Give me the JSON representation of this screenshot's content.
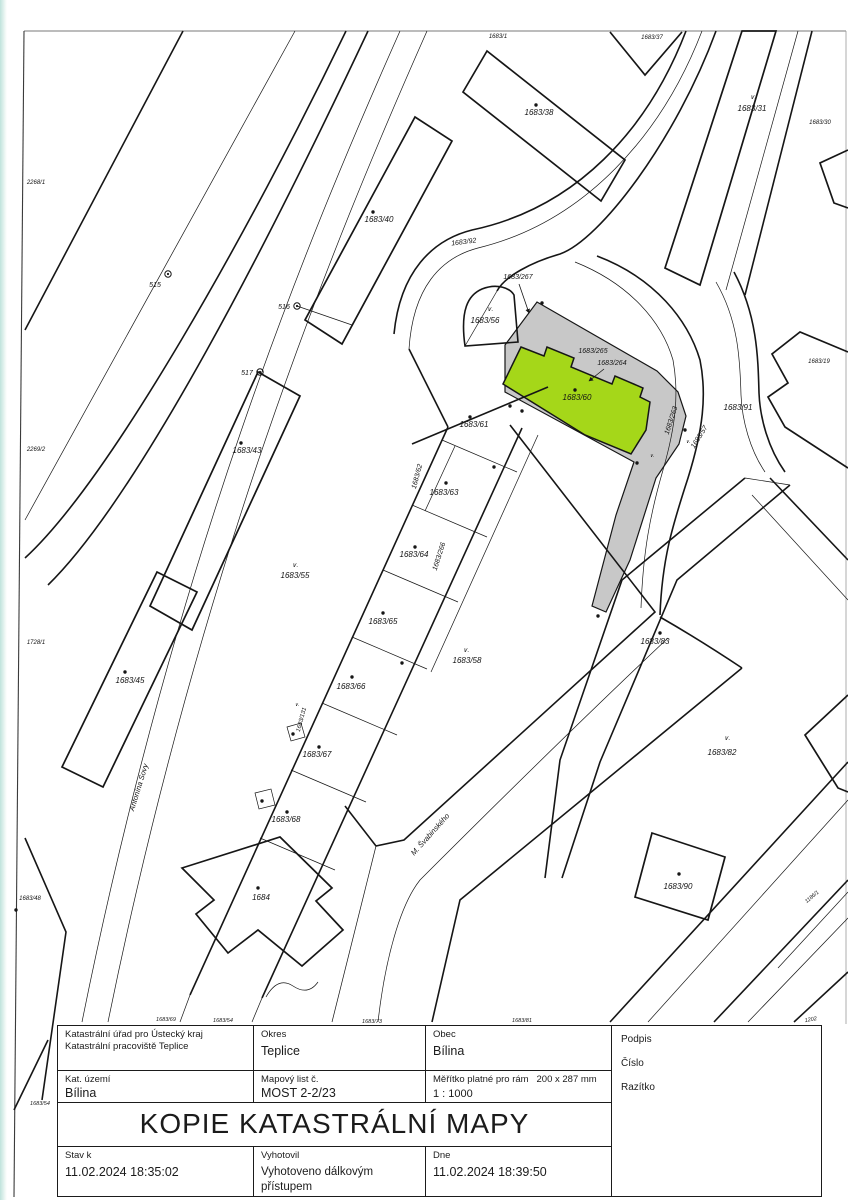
{
  "document": {
    "title": "KOPIE KATASTRÁLNÍ MAPY",
    "table": {
      "office_line1": "Katastrální úřad pro Ústecký kraj",
      "office_line2": "Katastrální pracoviště Teplice",
      "okres_label": "Okres",
      "okres_value": "Teplice",
      "obec_label": "Obec",
      "obec_value": "Bílina",
      "kat_uzemi_label": "Kat. území",
      "kat_uzemi_value": "Bílina",
      "mapovy_list_label": "Mapový list č.",
      "mapovy_list_value": "MOST 2-2/23",
      "meritko_label": "Měřítko platné pro rám",
      "meritko_frame": "200 x 287 mm",
      "meritko_value": "1 : 1000",
      "podpis_label": "Podpis",
      "cislo_label": "Číslo",
      "razitko_label": "Razítko",
      "stav_label": "Stav k",
      "stav_value": "11.02.2024 18:35:02",
      "vyhotovil_label": "Vyhotovil",
      "vyhotovil_value": "Vyhotoveno dálkovým přístupem",
      "dne_label": "Dne",
      "dne_value": "11.02.2024 18:39:50"
    }
  },
  "map": {
    "highlighted_parcel": "1683/60",
    "colors": {
      "highlight_green": "#a5d719",
      "area_gray": "#c8c8c8",
      "line": "#161616"
    },
    "labels": [
      {
        "t": "2268/1",
        "x": 36,
        "y": 184,
        "s": 6
      },
      {
        "t": "2269/2",
        "x": 36,
        "y": 451,
        "s": 6
      },
      {
        "t": "1728/1",
        "x": 36,
        "y": 644,
        "s": 6
      },
      {
        "t": "1683/48",
        "x": 30,
        "y": 900,
        "s": 6
      },
      {
        "t": "1683/54",
        "x": 40,
        "y": 1105,
        "s": 5.5
      },
      {
        "t": "515",
        "x": 155,
        "y": 287,
        "s": 7
      },
      {
        "t": "516",
        "x": 284,
        "y": 309,
        "s": 7
      },
      {
        "t": "517",
        "x": 247,
        "y": 375,
        "s": 7
      },
      {
        "t": "1683/43",
        "x": 247,
        "y": 453,
        "s": 8
      },
      {
        "t": "1683/45",
        "x": 130,
        "y": 683,
        "s": 8
      },
      {
        "t": "Antonína Sovy",
        "x": 141,
        "y": 788,
        "r": -73,
        "s": 7.5
      },
      {
        "t": "1683/40",
        "x": 379,
        "y": 222,
        "s": 8
      },
      {
        "t": "1683/38",
        "x": 539,
        "y": 115,
        "s": 8
      },
      {
        "t": "1683/1",
        "x": 498,
        "y": 38,
        "s": 6
      },
      {
        "t": "1683/37",
        "x": 652,
        "y": 39,
        "s": 6
      },
      {
        "t": "1683/31",
        "x": 752,
        "y": 111,
        "s": 8
      },
      {
        "t": "1683/30",
        "x": 820,
        "y": 124,
        "s": 6
      },
      {
        "t": "1683/92",
        "x": 464,
        "y": 244,
        "r": -7,
        "s": 7
      },
      {
        "t": "1683/267",
        "x": 518,
        "y": 279,
        "s": 7
      },
      {
        "t": "1683/56",
        "x": 485,
        "y": 323,
        "s": 8
      },
      {
        "t": "1683/265",
        "x": 593,
        "y": 353,
        "s": 7
      },
      {
        "t": "1683/264",
        "x": 612,
        "y": 365,
        "s": 7
      },
      {
        "t": "1683/60",
        "x": 577,
        "y": 400,
        "s": 8
      },
      {
        "t": "1683/61",
        "x": 474,
        "y": 427,
        "s": 8
      },
      {
        "t": "1683/62",
        "x": 419,
        "y": 477,
        "r": -75,
        "s": 7
      },
      {
        "t": "1683/63",
        "x": 444,
        "y": 495,
        "s": 8
      },
      {
        "t": "1683/266",
        "x": 441,
        "y": 557,
        "r": -72,
        "s": 7
      },
      {
        "t": "1683/64",
        "x": 414,
        "y": 557,
        "s": 8
      },
      {
        "t": "1683/65",
        "x": 383,
        "y": 624,
        "s": 8
      },
      {
        "t": "1683/55",
        "x": 295,
        "y": 578,
        "s": 8
      },
      {
        "t": "1683/58",
        "x": 467,
        "y": 663,
        "s": 8
      },
      {
        "t": "1683/66",
        "x": 351,
        "y": 689,
        "s": 8
      },
      {
        "t": "1683/131",
        "x": 303,
        "y": 720,
        "r": -75,
        "s": 6
      },
      {
        "t": "1683/67",
        "x": 317,
        "y": 757,
        "s": 8
      },
      {
        "t": "1683/68",
        "x": 286,
        "y": 822,
        "s": 8
      },
      {
        "t": "1684",
        "x": 261,
        "y": 900,
        "s": 8
      },
      {
        "t": "M. Švabinského",
        "x": 432,
        "y": 836,
        "r": -48,
        "s": 7.5
      },
      {
        "t": "1683/263",
        "x": 673,
        "y": 421,
        "r": -72,
        "s": 7
      },
      {
        "t": "1683/57",
        "x": 701,
        "y": 438,
        "r": -58,
        "s": 7
      },
      {
        "t": "1683/91",
        "x": 738,
        "y": 410,
        "s": 8
      },
      {
        "t": "1683/19",
        "x": 819,
        "y": 363,
        "s": 6
      },
      {
        "t": "1683/83",
        "x": 655,
        "y": 644,
        "s": 8
      },
      {
        "t": "1683/82",
        "x": 722,
        "y": 755,
        "s": 8
      },
      {
        "t": "1683/90",
        "x": 678,
        "y": 889,
        "s": 8
      },
      {
        "t": "1186/1",
        "x": 813,
        "y": 898,
        "r": -40,
        "s": 5.5
      },
      {
        "t": "1202",
        "x": 811,
        "y": 1021,
        "r": -10,
        "s": 5.5
      },
      {
        "t": "1683/69",
        "x": 166,
        "y": 1021,
        "s": 5.5
      },
      {
        "t": "1683/54",
        "x": 223,
        "y": 1022,
        "s": 5.5
      },
      {
        "t": "1683/73",
        "x": 372,
        "y": 1023,
        "s": 5.5
      },
      {
        "t": "1683/81",
        "x": 522,
        "y": 1022,
        "s": 5.5
      }
    ],
    "dots": [
      [
        536,
        105
      ],
      [
        373,
        212
      ],
      [
        241,
        443
      ],
      [
        125,
        672
      ],
      [
        575,
        390
      ],
      [
        470,
        417
      ],
      [
        446,
        483
      ],
      [
        415,
        547
      ],
      [
        383,
        613
      ],
      [
        352,
        677
      ],
      [
        319,
        747
      ],
      [
        287,
        812
      ],
      [
        258,
        888
      ],
      [
        660,
        633
      ],
      [
        679,
        874
      ],
      [
        542,
        303
      ],
      [
        510,
        406
      ],
      [
        522,
        411
      ],
      [
        685,
        430
      ],
      [
        637,
        463
      ],
      [
        598,
        616
      ],
      [
        402,
        663
      ],
      [
        494,
        467
      ],
      [
        293,
        734
      ],
      [
        262,
        801
      ],
      [
        16,
        910
      ]
    ],
    "circle_points": [
      [
        168,
        274
      ],
      [
        297,
        306
      ],
      [
        260,
        372
      ]
    ],
    "v_symbols": [
      {
        "x": 753,
        "y": 99
      },
      {
        "x": 490,
        "y": 311
      },
      {
        "x": 295,
        "y": 567
      },
      {
        "x": 466,
        "y": 652
      },
      {
        "x": 727,
        "y": 740
      },
      {
        "x": 297,
        "y": 706,
        "s": 5
      },
      {
        "x": 652,
        "y": 457,
        "s": 5
      },
      {
        "x": 688,
        "y": 443,
        "s": 5
      }
    ],
    "arrows": [
      {
        "x1": 519,
        "y1": 284,
        "x2": 529,
        "y2": 313
      },
      {
        "x1": 604,
        "y1": 369,
        "x2": 589,
        "y2": 381
      }
    ]
  }
}
